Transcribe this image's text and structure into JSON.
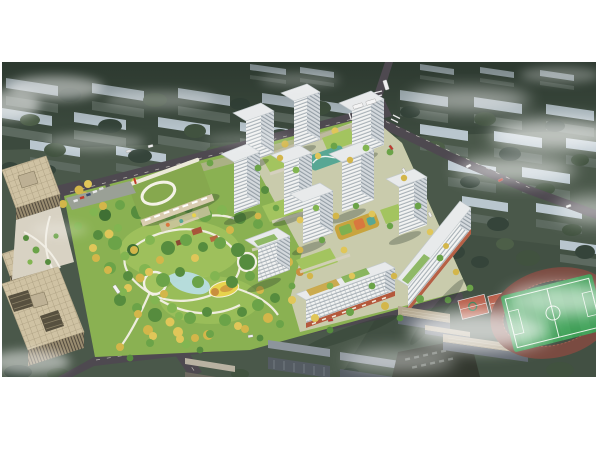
{
  "scene": {
    "type": "architectural-aerial-rendering",
    "description": "Bird's-eye masterplan rendering of a residential development: white high-rise towers around landscaped courtyards, a large central park with looping paths and a pond, a kindergarten with a green roof, tree-lined boulevards, beige office towers on the left, a school campus with running track and sports field at the lower right, surrounded by muted existing city blocks and drifting clouds",
    "regions": [
      {
        "name": "context-city-blocks",
        "label": "Existing city blocks"
      },
      {
        "name": "road-network",
        "label": "Perimeter roads and intersection"
      },
      {
        "name": "central-park",
        "label": "Central landscaped park"
      },
      {
        "name": "kindergarten",
        "label": "Kindergarten with green roof"
      },
      {
        "name": "residential-towers",
        "label": "White residential tower cluster"
      },
      {
        "name": "retail-slabs",
        "label": "Mid-rise slabs with street retail"
      },
      {
        "name": "office-towers",
        "label": "Office towers and plaza"
      },
      {
        "name": "sports-campus",
        "label": "School campus with track and courts"
      },
      {
        "name": "clouds",
        "label": "Fog and clouds"
      }
    ]
  },
  "colors": {
    "canvas_bg": "#ffffff",
    "ctx_ground": "#4a584a",
    "ctx_ground_dark": "#3c4a3e",
    "ctx_roof": "#b9c6ce",
    "ctx_wall": "#5d6a60",
    "ctx_tree_1": "#35443a",
    "ctx_tree_2": "#41523f",
    "ctx_tree_3": "#4d5f48",
    "road": "#4e4950",
    "road_dash": "#d8d3cb",
    "sidewalk": "#b9b09b",
    "lawn": "#8ab152",
    "lawn_2": "#a3c45f",
    "park_path": "#f3f0e6",
    "water": "#b9dfe9",
    "play_yellow": "#e7d34d",
    "tree_a": "#3f7034",
    "tree_b": "#568c3e",
    "tree_c": "#6ba348",
    "tree_d": "#82b551",
    "tree_y": "#d3b64a",
    "tree_y2": "#e0c659",
    "tree_o": "#c98f3e",
    "twr_face": "#f2f3f2",
    "twr_band": "#a7b0b6",
    "twr_face_s": "#d4d9dd",
    "twr_band_s": "#949ea6",
    "twr_roof": "#e8eaeb",
    "retail": "#b4593c",
    "garden_teal": "#58a794",
    "garden_yellow": "#c8a43e",
    "off_roof": "#cfc2a3",
    "off_wall": "#998c70",
    "plaza": "#d8d2c3",
    "school_roof": "#86a84e",
    "school_wall": "#d9cdb0",
    "pitch": "#3f9e57",
    "track": "#7a4b41",
    "court": "#b65a45",
    "campus_roof": "#b3a78f",
    "campus_wall": "#606770",
    "bot_roof": "#8d959c",
    "bot_wall": "#555c63",
    "fog": "#ffffff",
    "shadow": "#263427"
  }
}
